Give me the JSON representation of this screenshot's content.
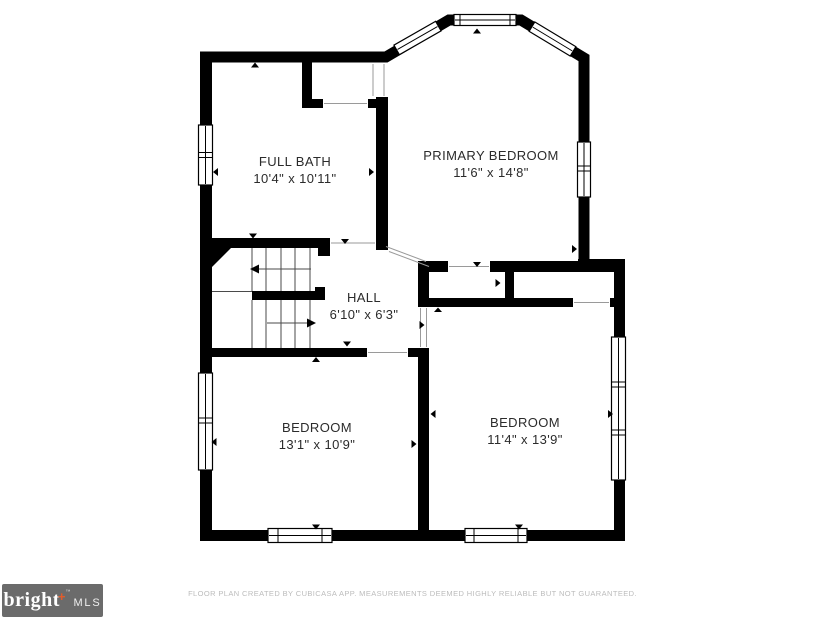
{
  "plan": {
    "rooms": [
      {
        "name": "FULL BATH",
        "dims": "10'4\" x 10'11\""
      },
      {
        "name": "PRIMARY BEDROOM",
        "dims": "11'6\" x 14'8\""
      },
      {
        "name": "HALL",
        "dims": "6'10\" x 6'3\""
      },
      {
        "name": "BEDROOM",
        "dims": "13'1\" x 10'9\""
      },
      {
        "name": "BEDROOM",
        "dims": "11'4\" x 13'9\""
      }
    ]
  },
  "footer": {
    "logo": {
      "brand": "bright",
      "plus": "+",
      "trademark": "™",
      "suffix": "MLS"
    },
    "disclaimer": "FLOOR PLAN CREATED BY CUBICASA APP. MEASUREMENTS DEEMED HIGHLY RELIABLE BUT NOT GUARANTEED."
  },
  "colors": {
    "wall": "#000000",
    "label": "#2b2b2b",
    "opening_line": "#9a9a9a",
    "stair_line": "#4a4a4a",
    "logo_bg": "#6b6b6b",
    "logo_plus": "#e05c2b",
    "disclaimer": "#bcbcbc"
  }
}
